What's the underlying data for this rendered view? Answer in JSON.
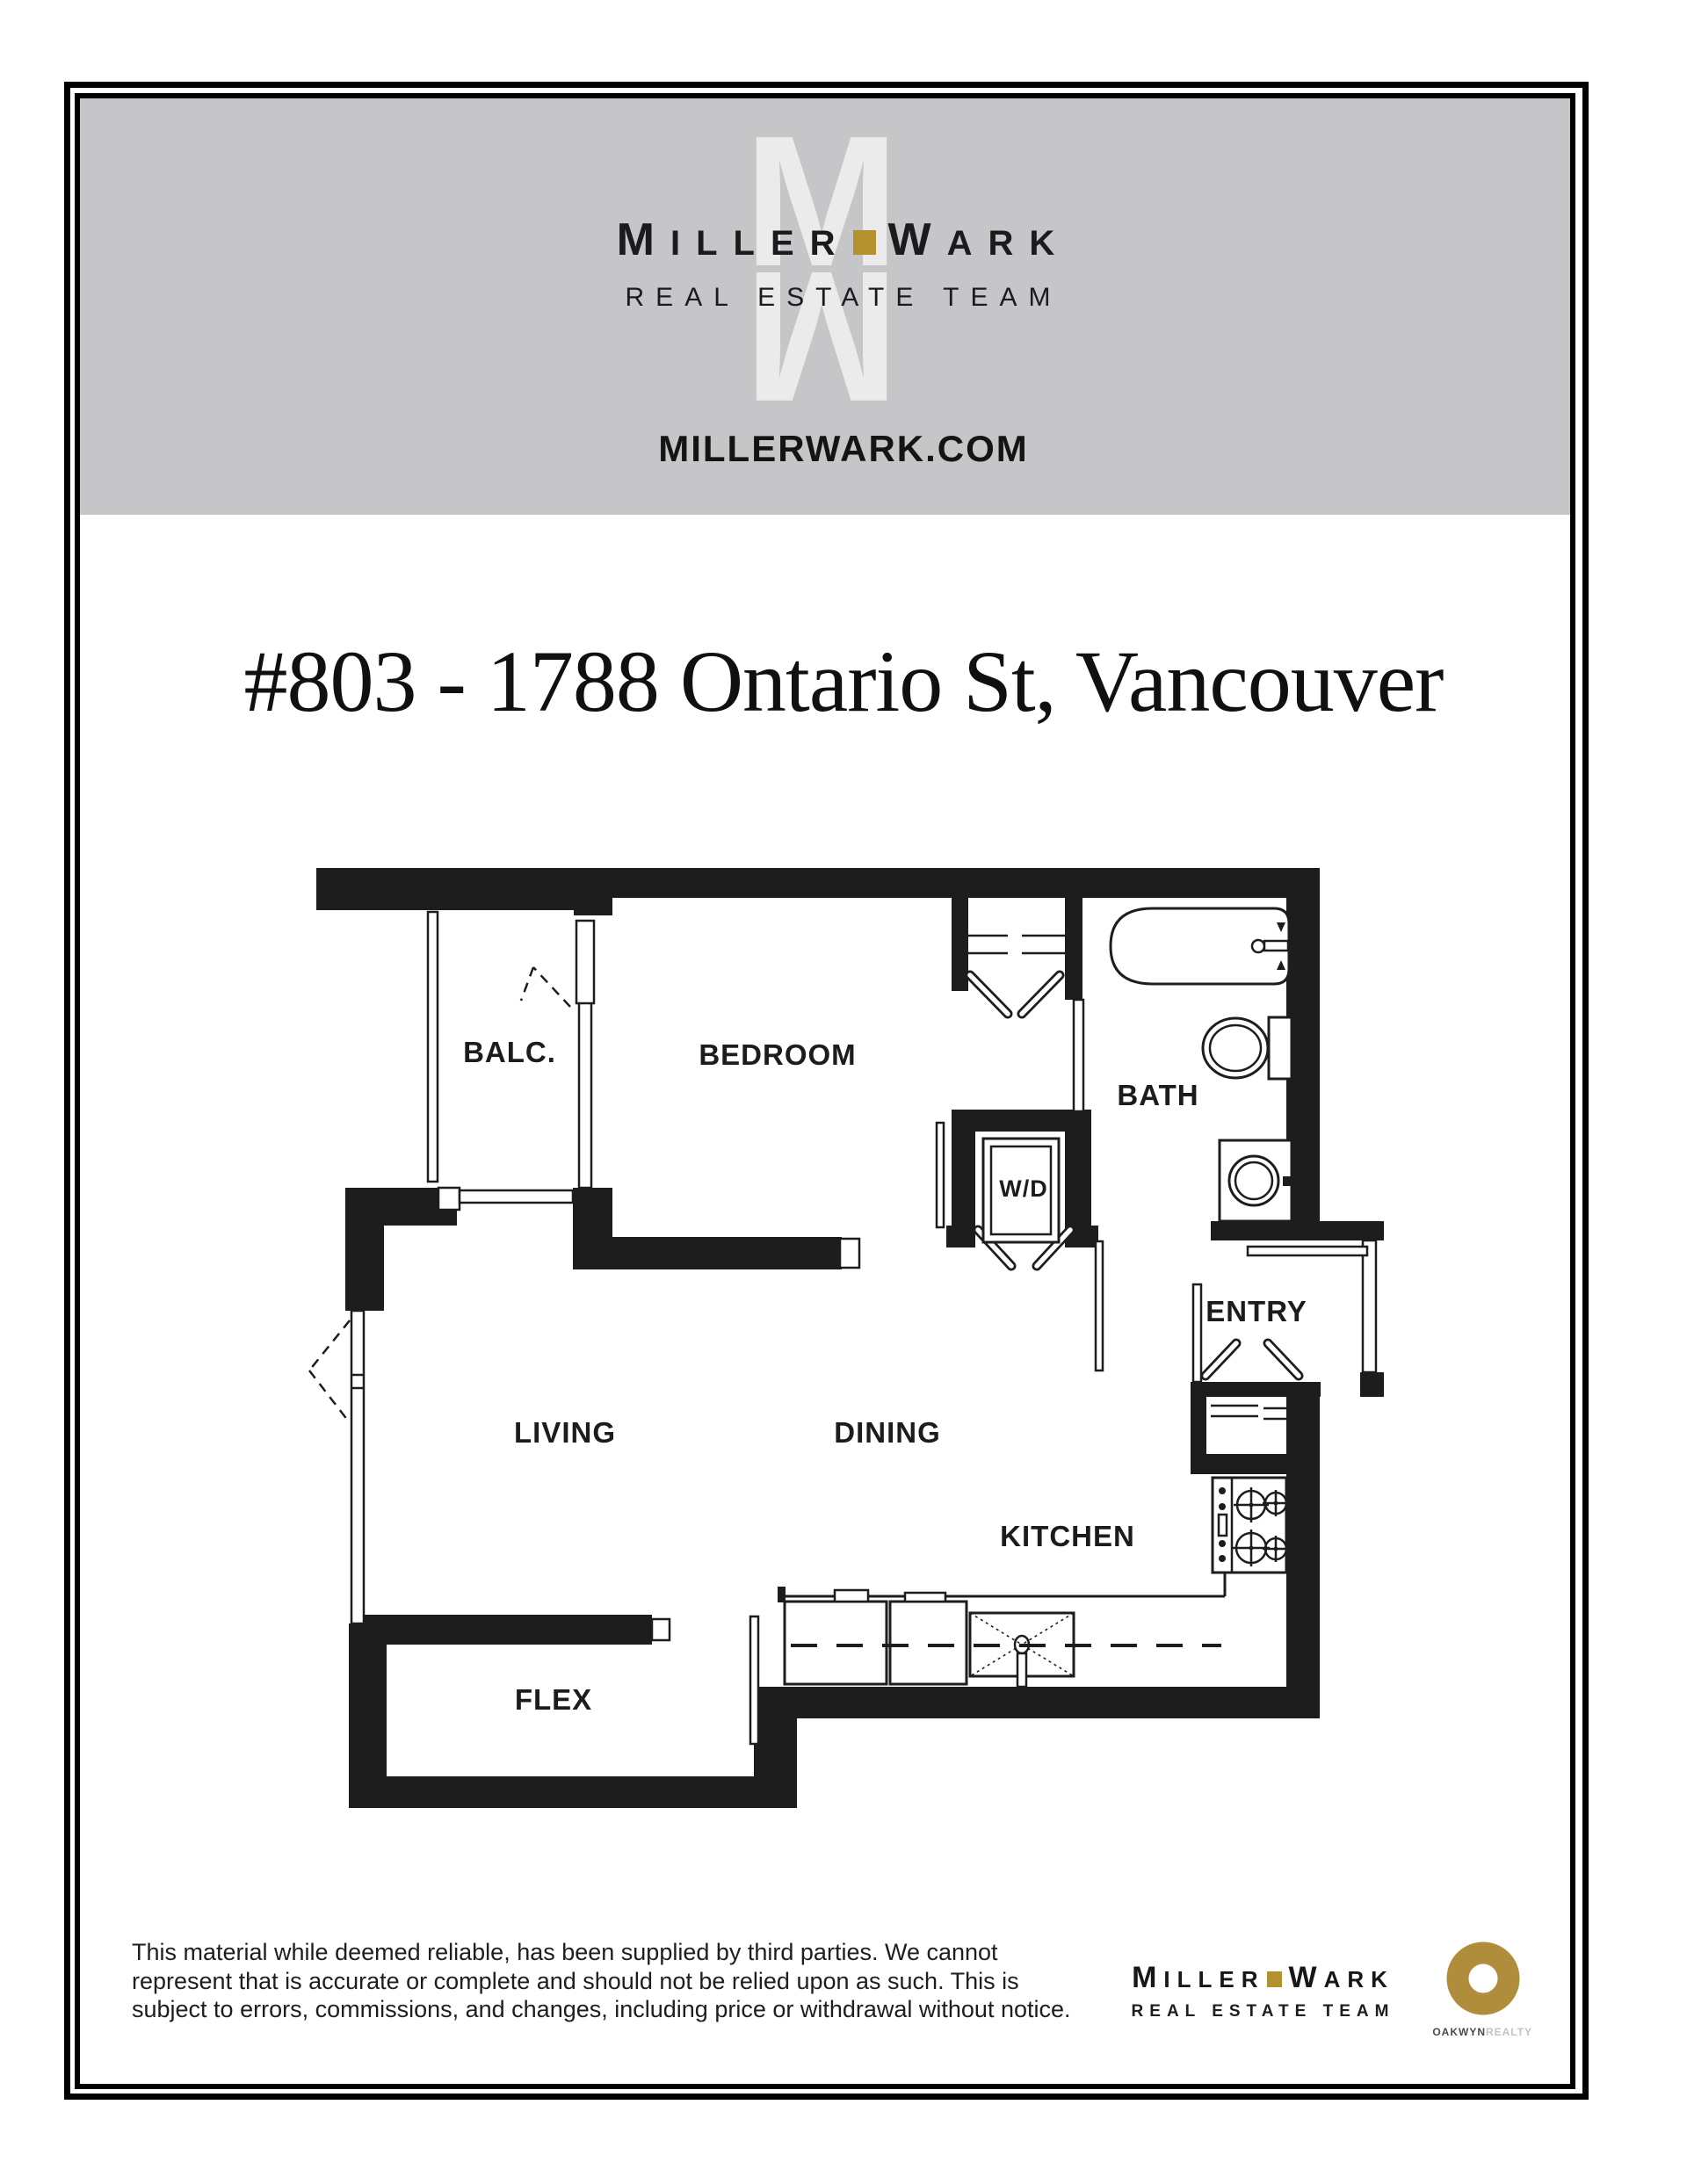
{
  "brand": {
    "miller_initial": "M",
    "miller_rest": "ILLER",
    "wark_initial": "W",
    "wark_rest": "ARK",
    "tagline": "REAL ESTATE TEAM",
    "accent_gold": "#b3912f",
    "monogram_letter": "M",
    "monogram_color": "#ebebec"
  },
  "header": {
    "banner_bg": "#c6c6c8",
    "website": "MILLERWARK.COM"
  },
  "listing": {
    "title": "#803 - 1788 Ontario St, Vancouver"
  },
  "floorplan": {
    "line_color": "#1d1d1d",
    "labels": [
      {
        "text": "BALC."
      },
      {
        "text": "BEDROOM"
      },
      {
        "text": "BATH"
      },
      {
        "text": "W/D"
      },
      {
        "text": "ENTRY"
      },
      {
        "text": "LIVING"
      },
      {
        "text": "DINING"
      },
      {
        "text": "KITCHEN"
      },
      {
        "text": "FLEX"
      }
    ]
  },
  "footer": {
    "disclaimer_lines": [
      "This material while deemed reliable, has been supplied by third parties. We cannot",
      "represent that is accurate or complete and should not be relied upon as such. This is",
      "subject to errors, commissions, and changes, including price or withdrawal without notice."
    ],
    "oakwyn": {
      "name_bold": "OAKWYN",
      "name_light": "REALTY",
      "ring_color": "#b08d3b"
    }
  }
}
